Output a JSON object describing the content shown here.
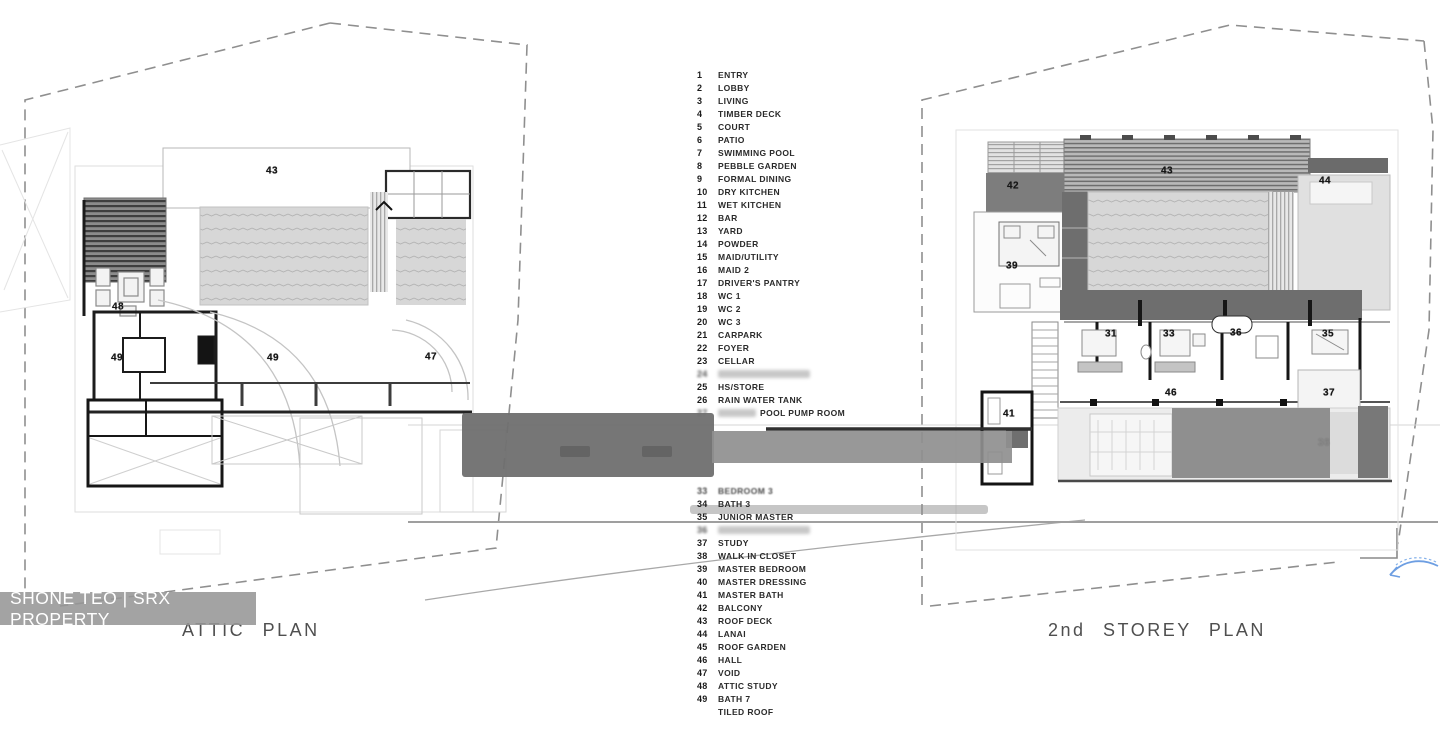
{
  "watermark": {
    "text": "SHONE TEO | SRX PROPERTY"
  },
  "plans": {
    "left": {
      "title": "ATTIC PLAN",
      "labels": [
        {
          "n": "43",
          "x": 272,
          "y": 171
        },
        {
          "n": "48",
          "x": 118,
          "y": 307
        },
        {
          "n": "49",
          "x": 117,
          "y": 358
        },
        {
          "n": "49",
          "x": 273,
          "y": 358
        },
        {
          "n": "47",
          "x": 431,
          "y": 357
        }
      ]
    },
    "right": {
      "title": "2nd STOREY PLAN",
      "labels": [
        {
          "n": "42",
          "x": 1013,
          "y": 186
        },
        {
          "n": "43",
          "x": 1167,
          "y": 171
        },
        {
          "n": "44",
          "x": 1325,
          "y": 181
        },
        {
          "n": "39",
          "x": 1012,
          "y": 266
        },
        {
          "n": "31",
          "x": 1111,
          "y": 334
        },
        {
          "n": "33",
          "x": 1169,
          "y": 334
        },
        {
          "n": "36",
          "x": 1236,
          "y": 333
        },
        {
          "n": "35",
          "x": 1328,
          "y": 334
        },
        {
          "n": "46",
          "x": 1171,
          "y": 393
        },
        {
          "n": "37",
          "x": 1329,
          "y": 393
        },
        {
          "n": "41",
          "x": 1009,
          "y": 414
        },
        {
          "n": "36",
          "x": 1324,
          "y": 443,
          "muted": true
        }
      ]
    }
  },
  "legend": {
    "items": [
      {
        "num": "1",
        "label": "ENTRY"
      },
      {
        "num": "2",
        "label": "LOBBY"
      },
      {
        "num": "3",
        "label": "LIVING"
      },
      {
        "num": "4",
        "label": "TIMBER DECK"
      },
      {
        "num": "5",
        "label": "COURT"
      },
      {
        "num": "6",
        "label": "PATIO"
      },
      {
        "num": "7",
        "label": "SWIMMING POOL"
      },
      {
        "num": "8",
        "label": "PEBBLE GARDEN"
      },
      {
        "num": "9",
        "label": "FORMAL DINING"
      },
      {
        "num": "10",
        "label": "DRY KITCHEN"
      },
      {
        "num": "11",
        "label": "WET KITCHEN"
      },
      {
        "num": "12",
        "label": "BAR"
      },
      {
        "num": "13",
        "label": "YARD"
      },
      {
        "num": "14",
        "label": "POWDER"
      },
      {
        "num": "15",
        "label": "MAID/UTILITY"
      },
      {
        "num": "16",
        "label": "MAID 2"
      },
      {
        "num": "17",
        "label": "DRIVER'S PANTRY"
      },
      {
        "num": "18",
        "label": "WC 1"
      },
      {
        "num": "19",
        "label": "WC 2"
      },
      {
        "num": "20",
        "label": "WC 3"
      },
      {
        "num": "21",
        "label": "CARPARK"
      },
      {
        "num": "22",
        "label": "FOYER"
      },
      {
        "num": "23",
        "label": "CELLAR"
      },
      {
        "num": "24",
        "label": "",
        "redacted": "full"
      },
      {
        "num": "25",
        "label": "HS/STORE"
      },
      {
        "num": "26",
        "label": "RAIN WATER TANK"
      },
      {
        "num": "27",
        "label": "POOL PUMP ROOM",
        "redacted": "prefix"
      },
      {
        "num": "",
        "label": ""
      },
      {
        "num": "",
        "label": ""
      },
      {
        "num": "",
        "label": ""
      },
      {
        "num": "",
        "label": ""
      },
      {
        "num": "",
        "label": ""
      },
      {
        "num": "33",
        "label": "BEDROOM 3",
        "redacted": "smudge"
      },
      {
        "num": "34",
        "label": "BATH 3"
      },
      {
        "num": "35",
        "label": "JUNIOR MASTER"
      },
      {
        "num": "36",
        "label": "",
        "redacted": "full"
      },
      {
        "num": "37",
        "label": "STUDY"
      },
      {
        "num": "38",
        "label": "WALK IN CLOSET"
      },
      {
        "num": "39",
        "label": "MASTER  BEDROOM"
      },
      {
        "num": "40",
        "label": "MASTER DRESSING"
      },
      {
        "num": "41",
        "label": "MASTER BATH"
      },
      {
        "num": "42",
        "label": "BALCONY"
      },
      {
        "num": "43",
        "label": "ROOF DECK"
      },
      {
        "num": "44",
        "label": "LANAI"
      },
      {
        "num": "45",
        "label": "ROOF GARDEN"
      },
      {
        "num": "46",
        "label": "HALL"
      },
      {
        "num": "47",
        "label": "VOID"
      },
      {
        "num": "48",
        "label": "ATTIC STUDY"
      },
      {
        "num": "49",
        "label": "BATH 7"
      },
      {
        "num": "",
        "label": "TILED ROOF"
      }
    ]
  },
  "colors": {
    "bridge_block": "#6f6f6f",
    "bridge_bar": "#8f8f8f",
    "roof_hatch": "#d6d6d6",
    "louvre_dark": "#3f3f3f",
    "dark_band": "#6e6e6e",
    "boundary_dash": "#8f8f8f",
    "watermark_bg": "#969696",
    "annotation_blue": "#6d9ee2"
  }
}
